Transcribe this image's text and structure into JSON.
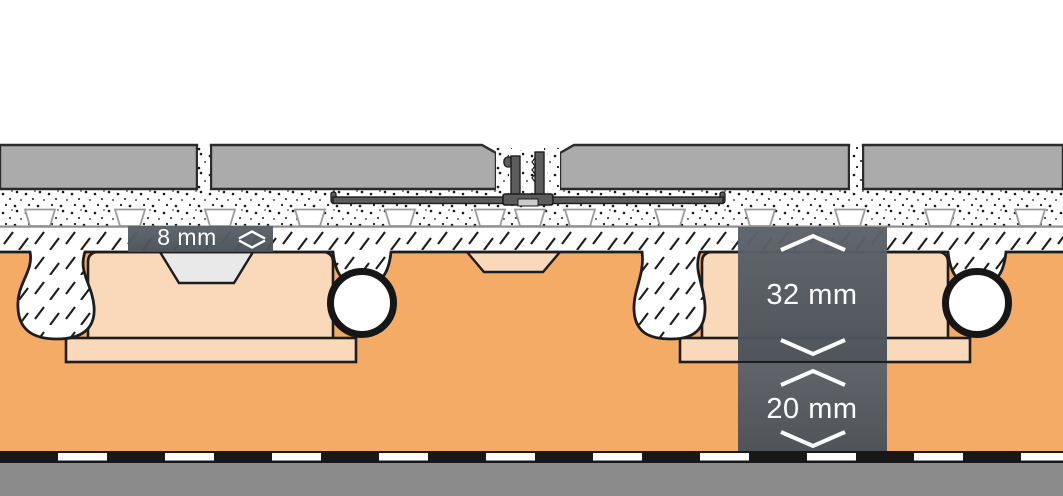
{
  "diagram": {
    "title": "floor-assembly-cross-section",
    "labels": {
      "thinbed": {
        "text": "8 mm",
        "icon": "extent-diamond-icon"
      },
      "screed": {
        "text": "32 mm",
        "icon": "extent-chevrons-icon"
      },
      "panel": {
        "text": "20 mm",
        "icon": "extent-chevrons-icon"
      }
    },
    "layers": [
      {
        "id": "tile-covering"
      },
      {
        "id": "grout-joint"
      },
      {
        "id": "movement-joint-profile"
      },
      {
        "id": "thinbed-mortar-with-studded-membrane"
      },
      {
        "id": "screed-hatched"
      },
      {
        "id": "heating-pipe"
      },
      {
        "id": "studded-panel"
      },
      {
        "id": "separation-foil-dashed"
      },
      {
        "id": "substrate"
      }
    ],
    "colors": {
      "background": "#ffffff",
      "tile_gray": "#ababab",
      "outline_black": "#1d1d1d",
      "speckle_black": "#161616",
      "stud_outline_gray": "#9b9b9b",
      "membrane_line_gray": "#8f8f8f",
      "panel_orange": "#f4ab66",
      "stud_peach": "#fad9bb",
      "notch_gray": "#e9e9e9",
      "pipe_white": "#ffffff",
      "profile_gray": "#5c5c5c",
      "insert_gray": "#cccccc",
      "label_bg": "#51575e",
      "label_bg_top": "#5c626a",
      "label_text": "#ffffff",
      "foil_black": "#181818",
      "foil_dash_white": "#ffffff",
      "substrate_gray": "#8b8b8b"
    }
  }
}
